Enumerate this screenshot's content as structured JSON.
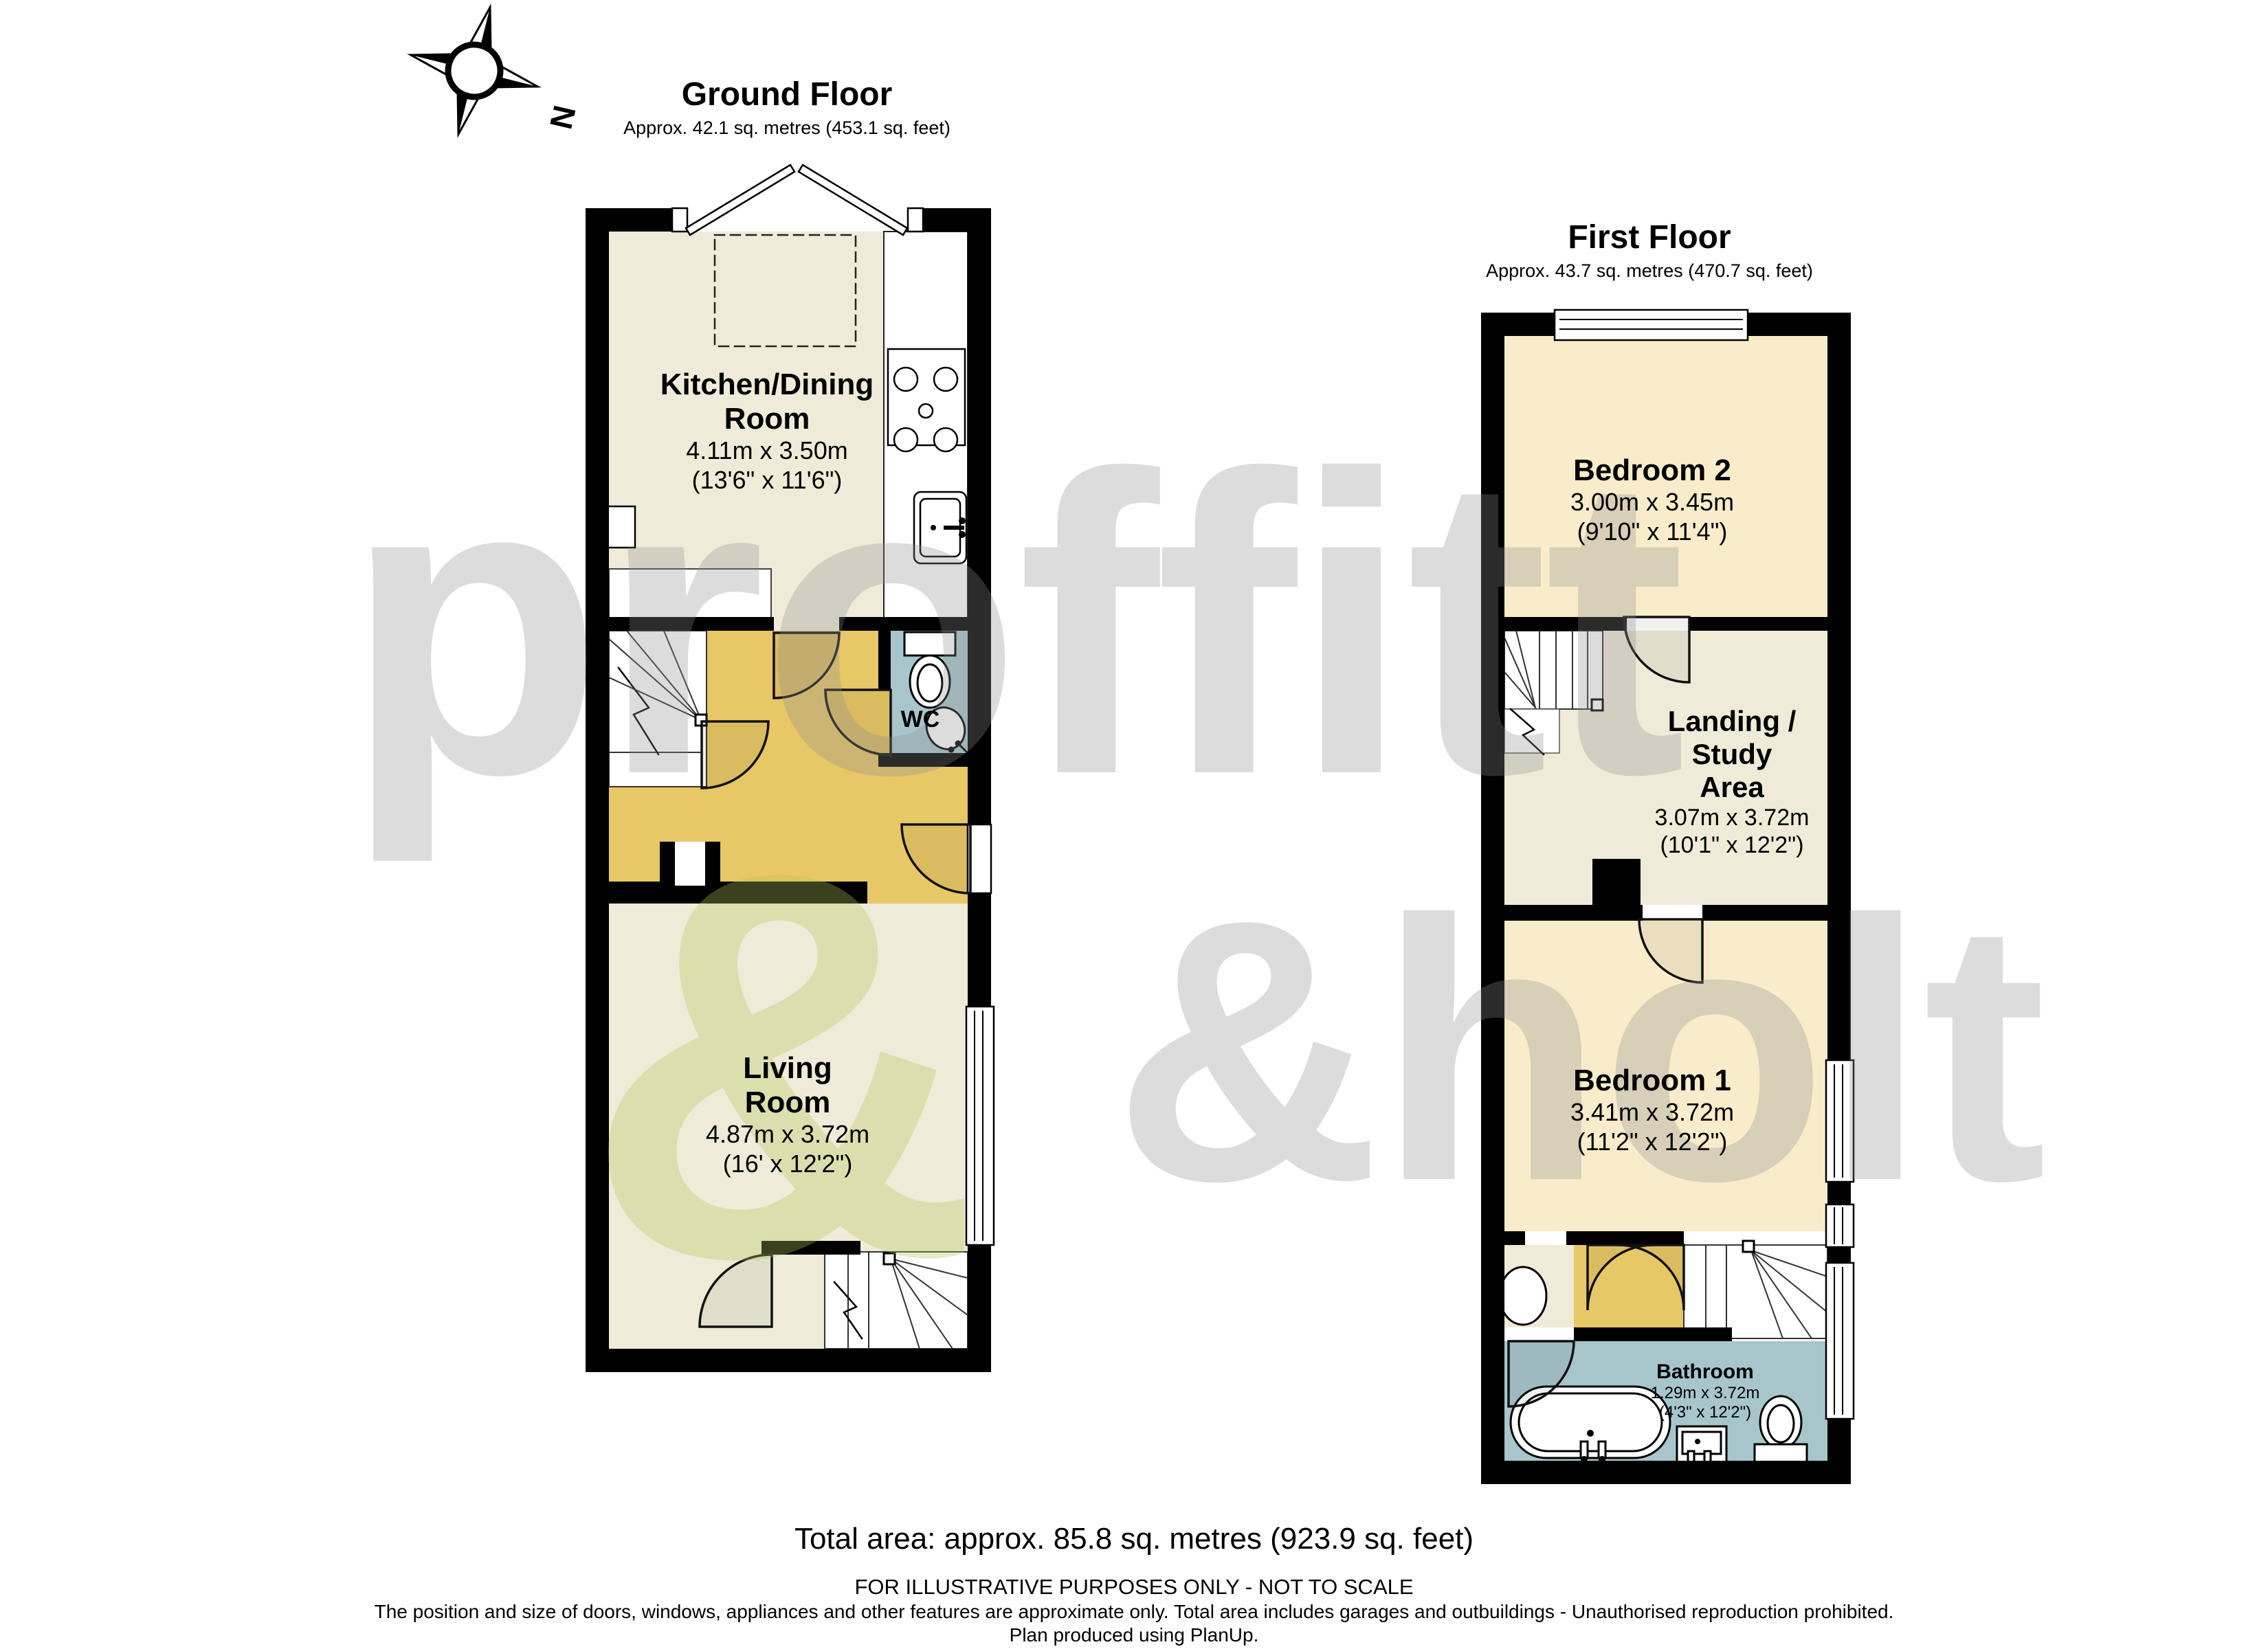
{
  "compass": {
    "north_label": "N"
  },
  "ground_floor": {
    "title": "Ground Floor",
    "subtitle": "Approx. 42.1 sq. metres (453.1 sq. feet)"
  },
  "first_floor": {
    "title": "First Floor",
    "subtitle": "Approx. 43.7 sq. metres (470.7 sq. feet)"
  },
  "rooms": {
    "kitchen": {
      "name": "Kitchen/Dining\nRoom",
      "metric": "4.11m x 3.50m",
      "imperial": "(13'6\" x 11'6\")"
    },
    "wc": {
      "name": "WC"
    },
    "living": {
      "name": "Living\nRoom",
      "metric": "4.87m x 3.72m",
      "imperial": "(16' x 12'2\")"
    },
    "bedroom2": {
      "name": "Bedroom 2",
      "metric": "3.00m x 3.45m",
      "imperial": "(9'10\" x 11'4\")"
    },
    "landing": {
      "name": "Landing /\nStudy\nArea",
      "metric": "3.07m x 3.72m",
      "imperial": "(10'1\" x 12'2\")"
    },
    "bedroom1": {
      "name": "Bedroom 1",
      "metric": "3.41m x 3.72m",
      "imperial": "(11'2\" x 12'2\")"
    },
    "bathroom": {
      "name": "Bathroom",
      "metric": "1.29m x 3.72m",
      "imperial": "(4'3\" x 12'2\")"
    }
  },
  "footer": {
    "total": "Total area: approx. 85.8 sq. metres (923.9 sq. feet)",
    "line1": "FOR ILLUSTRATIVE PURPOSES ONLY - NOT TO SCALE",
    "line2": "The position and size of doors, windows, appliances and other features are approximate only. Total area includes garages and outbuildings - Unauthorised reproduction prohibited.",
    "line3": "Plan produced using PlanUp."
  },
  "watermark": {
    "word1": "proffitt",
    "word2": "&holt",
    "ampersand": "&"
  },
  "colors": {
    "floor_cream": "#f0ebd8",
    "floor_peach": "#f9ecca",
    "floor_yellow": "#e8c766",
    "floor_teal": "#a7c6cc",
    "wall": "#000000",
    "watermark_grey": "#8f8f8f",
    "watermark_green": "#b5c55a"
  }
}
